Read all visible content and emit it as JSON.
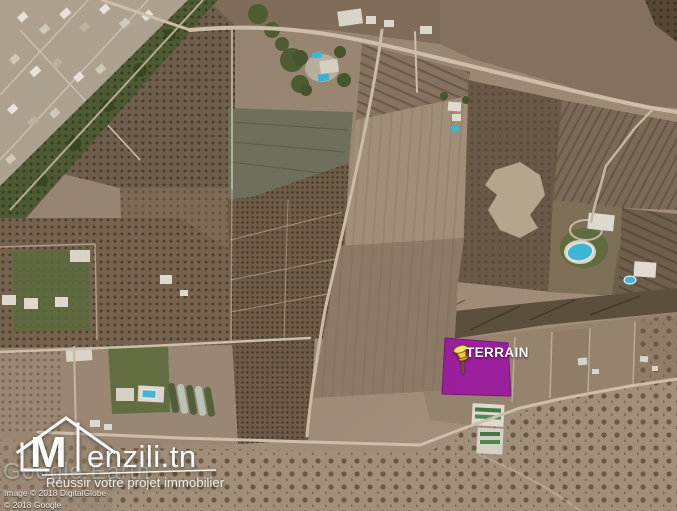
{
  "map": {
    "parcel_label": "TERRAIN",
    "overlay_color": "#9b1d9e",
    "overlay_border_color": "#7e1180",
    "pin_color": "#f2cf2e",
    "pin_cap_color": "#f8e565"
  },
  "icons": {
    "pin": "pushpin-icon",
    "logo": "house-monogram-icon"
  },
  "branding": {
    "monogram": "M",
    "wordmark": "enzili.tn",
    "tagline": "Réussir votre projet immobilier"
  },
  "credits": {
    "watermark": "Google Earth",
    "imagery": "Image © 2018 DigitalGlobe",
    "copyright": "© 2018 Google"
  }
}
